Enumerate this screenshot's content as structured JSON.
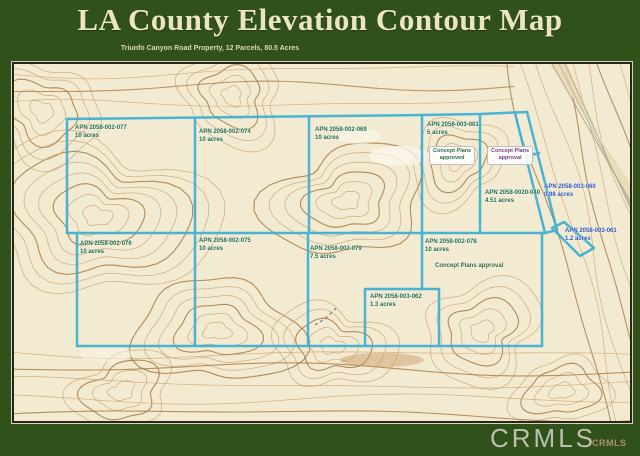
{
  "header": {
    "title": "LA County Elevation Contour Map",
    "subtitle": "Triunfo Canyon Road Property, 12 Parcels, 80.5 Acres"
  },
  "map": {
    "parcels": [
      {
        "apn": "APN 2058-002-077",
        "acreage": "10 acres"
      },
      {
        "apn": "APN 2058-002-074",
        "acreage": "10 acres"
      },
      {
        "apn": "APN 2058-002-069",
        "acreage": "10 acres"
      },
      {
        "apn": "APN 2058-003-001",
        "acreage": "5 acres"
      },
      {
        "apn": "APN 2058-0020-040",
        "acreage": "4.51 acres"
      },
      {
        "apn": "APN 2058-003-060",
        "acreage": "0.98 acres"
      },
      {
        "apn": "APN 2058-003-061",
        "acreage": "1.2 acres"
      },
      {
        "apn": "APN 2058-002-076",
        "acreage": "10 acres"
      },
      {
        "apn": "APN 2058-002-075",
        "acreage": "10 acres"
      },
      {
        "apn": "APN 2058-002-079",
        "acreage": "7.5 acres"
      },
      {
        "apn": "APN 2058-002-078",
        "acreage": "10 acres"
      },
      {
        "apn": "APN 2058-003-062",
        "acreage": "1.3 acres"
      }
    ],
    "annotations": [
      {
        "line1": "Concept Plans",
        "line2": "approved"
      },
      {
        "line1": "Concept Plans",
        "line2": "approval"
      },
      {
        "text": "Concept Plans approval"
      }
    ]
  },
  "footer": {
    "watermark": "CRMLS",
    "logo": "CRMLS"
  },
  "colors": {
    "band_green": "#31511a",
    "parcel_line_blue": "#3aafd4",
    "label_green": "#1f6b4a",
    "label_blue": "#2e55b5",
    "label_purple": "#7d3c8c",
    "map_cream": "#f3ead2",
    "contour_tan": "#c9a06b",
    "contour_brown": "#a8793f"
  }
}
